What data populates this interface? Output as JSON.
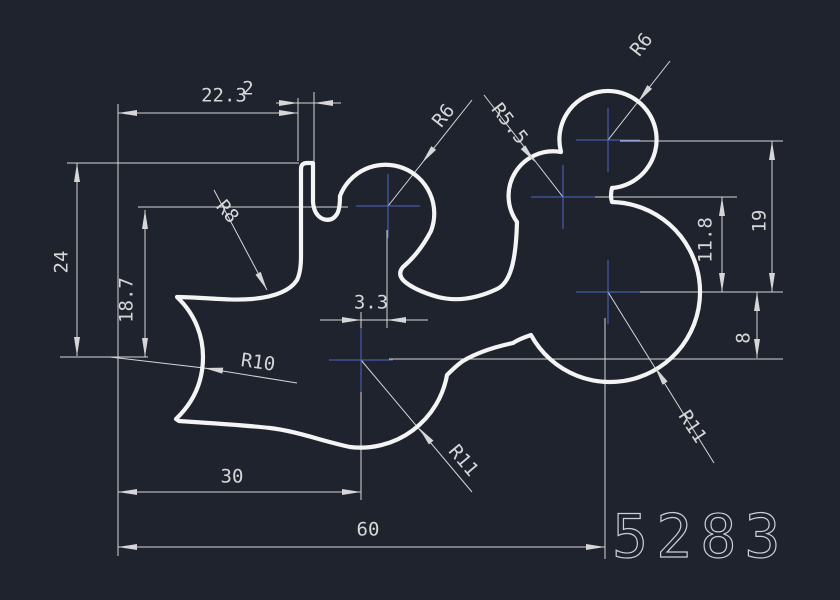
{
  "title": "CAD part drawing",
  "canvas": {
    "width": 840,
    "height": 600,
    "background": "#1e232d"
  },
  "colors": {
    "outline": "#f4f4f4",
    "dimension": "#d6d6d6",
    "center_mark": "#4d68c9",
    "id_text": "#c9cfd8"
  },
  "style": {
    "outline_width": 4.2,
    "dim_width": 1,
    "arrow_length": 19,
    "arrow_half_width": 3,
    "dim_font_size": 19,
    "id_font_size": 60,
    "cross_half": 32
  },
  "drawing_number": {
    "text": "5283",
    "x": 612,
    "y": 557
  },
  "outline": {
    "path": "M 301,256 L 301,169 Q 301,163 307,163 L 313,163 L 313,202 Q 314,215 323,219 Q 332,222 337,214 Q 340,209 340,196 A 48.6 48.6 0 1 1 431,231 C 421,250 411,260 403,267 Q 397,274 404,281 C 412,288 424,293 438,297 C 458,302 478,298 497,289 C 510,283 516,262 517,222 A 44.6 44.6 0 0 1 561,152 A 48.6 48.6 0 1 1 612,188 Q 610,196 612,202 A 90 90 0 1 1 531,335 Q 519,339 513,343 C 499,346 478,352 463,361 C 457,365 452,370 447,375 A 88 88 0 0 1 350,447 C 322,441 296,431 270,428 C 243,425 208,423 179,421 L 176,419 C 197,399 203,377 203,357 C 203,337 196,315 177,297 C 201,297 228,301 252,299 C 274,297 290,291 297,280 Q 301,272 301,256 Z"
  },
  "center_marks": [
    {
      "name": "center-r6-left",
      "x": 388,
      "y": 206
    },
    {
      "name": "center-r5-5",
      "x": 563,
      "y": 197
    },
    {
      "name": "center-r6-right",
      "x": 608,
      "y": 140
    },
    {
      "name": "center-r11-right",
      "x": 608,
      "y": 292
    },
    {
      "name": "center-r11-left",
      "x": 361,
      "y": 360
    }
  ],
  "thin_lines": [
    [
      118,
      104,
      118,
      556
    ],
    [
      298,
      98,
      298,
      161
    ],
    [
      314,
      92,
      314,
      161
    ],
    [
      67,
      163,
      299,
      163
    ],
    [
      138,
      207,
      348,
      207
    ],
    [
      60,
      357,
      148,
      357
    ],
    [
      361,
      312,
      361,
      336
    ],
    [
      361,
      384,
      361,
      500
    ],
    [
      387,
      230,
      387,
      328
    ],
    [
      605,
      318,
      605,
      559
    ],
    [
      620,
      141,
      783,
      141
    ],
    [
      577,
      197,
      737,
      197
    ],
    [
      622,
      292,
      783,
      292
    ],
    [
      389,
      359,
      783,
      359
    ],
    [
      118,
      113,
      298,
      113
    ],
    [
      276,
      103,
      341,
      103
    ],
    [
      77,
      163,
      77,
      356
    ],
    [
      145,
      210,
      145,
      357
    ],
    [
      118,
      492,
      361,
      492
    ],
    [
      118,
      547,
      605,
      547
    ],
    [
      320,
      320,
      428,
      320
    ],
    [
      722,
      197,
      722,
      292
    ],
    [
      772,
      141,
      772,
      292
    ],
    [
      757,
      292,
      757,
      358
    ],
    [
      214,
      190,
      267,
      290
    ],
    [
      388,
      206,
      472,
      100
    ],
    [
      484,
      95,
      563,
      197
    ],
    [
      608,
      140,
      670,
      61
    ],
    [
      110,
      357,
      204,
      368
    ],
    [
      204,
      368,
      297,
      383
    ],
    [
      361,
      360,
      472,
      492
    ],
    [
      608,
      292,
      714,
      463
    ]
  ],
  "arrows": [
    {
      "x": 118,
      "y": 113,
      "a": 180
    },
    {
      "x": 298,
      "y": 113,
      "a": 0
    },
    {
      "x": 298,
      "y": 103,
      "a": 0
    },
    {
      "x": 314,
      "y": 103,
      "a": 180
    },
    {
      "x": 77,
      "y": 163,
      "a": -90
    },
    {
      "x": 77,
      "y": 356,
      "a": 90
    },
    {
      "x": 145,
      "y": 210,
      "a": -90
    },
    {
      "x": 145,
      "y": 357,
      "a": 90
    },
    {
      "x": 118,
      "y": 492,
      "a": 180
    },
    {
      "x": 361,
      "y": 492,
      "a": 0
    },
    {
      "x": 118,
      "y": 547,
      "a": 180
    },
    {
      "x": 605,
      "y": 547,
      "a": 0
    },
    {
      "x": 361,
      "y": 320,
      "a": 0
    },
    {
      "x": 387,
      "y": 320,
      "a": 180
    },
    {
      "x": 722,
      "y": 197,
      "a": -90
    },
    {
      "x": 722,
      "y": 292,
      "a": 90
    },
    {
      "x": 772,
      "y": 141,
      "a": -90
    },
    {
      "x": 772,
      "y": 292,
      "a": 90
    },
    {
      "x": 757,
      "y": 292,
      "a": -90
    },
    {
      "x": 757,
      "y": 358,
      "a": 90
    },
    {
      "x": 267,
      "y": 290,
      "a": 62
    },
    {
      "x": 422,
      "y": 163,
      "a": 128
    },
    {
      "x": 535,
      "y": 162,
      "a": 51
    },
    {
      "x": 638,
      "y": 102,
      "a": 128
    },
    {
      "x": 204,
      "y": 368,
      "a": 188
    },
    {
      "x": 419,
      "y": 428,
      "a": 230
    },
    {
      "x": 655,
      "y": 367,
      "a": 238
    }
  ],
  "dim_texts": [
    {
      "name": "dim-width-22-3",
      "t": "22.3",
      "x": 224,
      "y": 96,
      "r": 0
    },
    {
      "name": "dim-slot-2",
      "t": "2",
      "x": 248,
      "y": 89,
      "r": 0
    },
    {
      "name": "dim-height-24",
      "t": "24",
      "x": 62,
      "y": 262,
      "r": -90
    },
    {
      "name": "dim-height-18-7",
      "t": "18.7",
      "x": 127,
      "y": 300,
      "r": -90
    },
    {
      "name": "dim-offset-3-3",
      "t": "3.3",
      "x": 371,
      "y": 303,
      "r": 0
    },
    {
      "name": "dim-width-30",
      "t": "30",
      "x": 232,
      "y": 477,
      "r": 0
    },
    {
      "name": "dim-width-60",
      "t": "60",
      "x": 368,
      "y": 530,
      "r": 0
    },
    {
      "name": "dim-height-11-8",
      "t": "11.8",
      "x": 706,
      "y": 240,
      "r": -90
    },
    {
      "name": "dim-height-19",
      "t": "19",
      "x": 760,
      "y": 221,
      "r": -90
    },
    {
      "name": "dim-height-8",
      "t": "8",
      "x": 744,
      "y": 338,
      "r": -90
    },
    {
      "name": "radius-r8",
      "t": "R8",
      "x": 227,
      "y": 212,
      "r": 50
    },
    {
      "name": "radius-r6-left",
      "t": "R6",
      "x": 444,
      "y": 116,
      "r": -52
    },
    {
      "name": "radius-r5-5",
      "t": "R5.5",
      "x": 509,
      "y": 124,
      "r": 52
    },
    {
      "name": "radius-r6-right",
      "t": "R6",
      "x": 642,
      "y": 45,
      "r": -52
    },
    {
      "name": "radius-r10",
      "t": "R10",
      "x": 258,
      "y": 363,
      "r": 8
    },
    {
      "name": "radius-r11-left",
      "t": "R11",
      "x": 463,
      "y": 461,
      "r": 50
    },
    {
      "name": "radius-r11-right",
      "t": "R11",
      "x": 692,
      "y": 427,
      "r": 57
    }
  ]
}
